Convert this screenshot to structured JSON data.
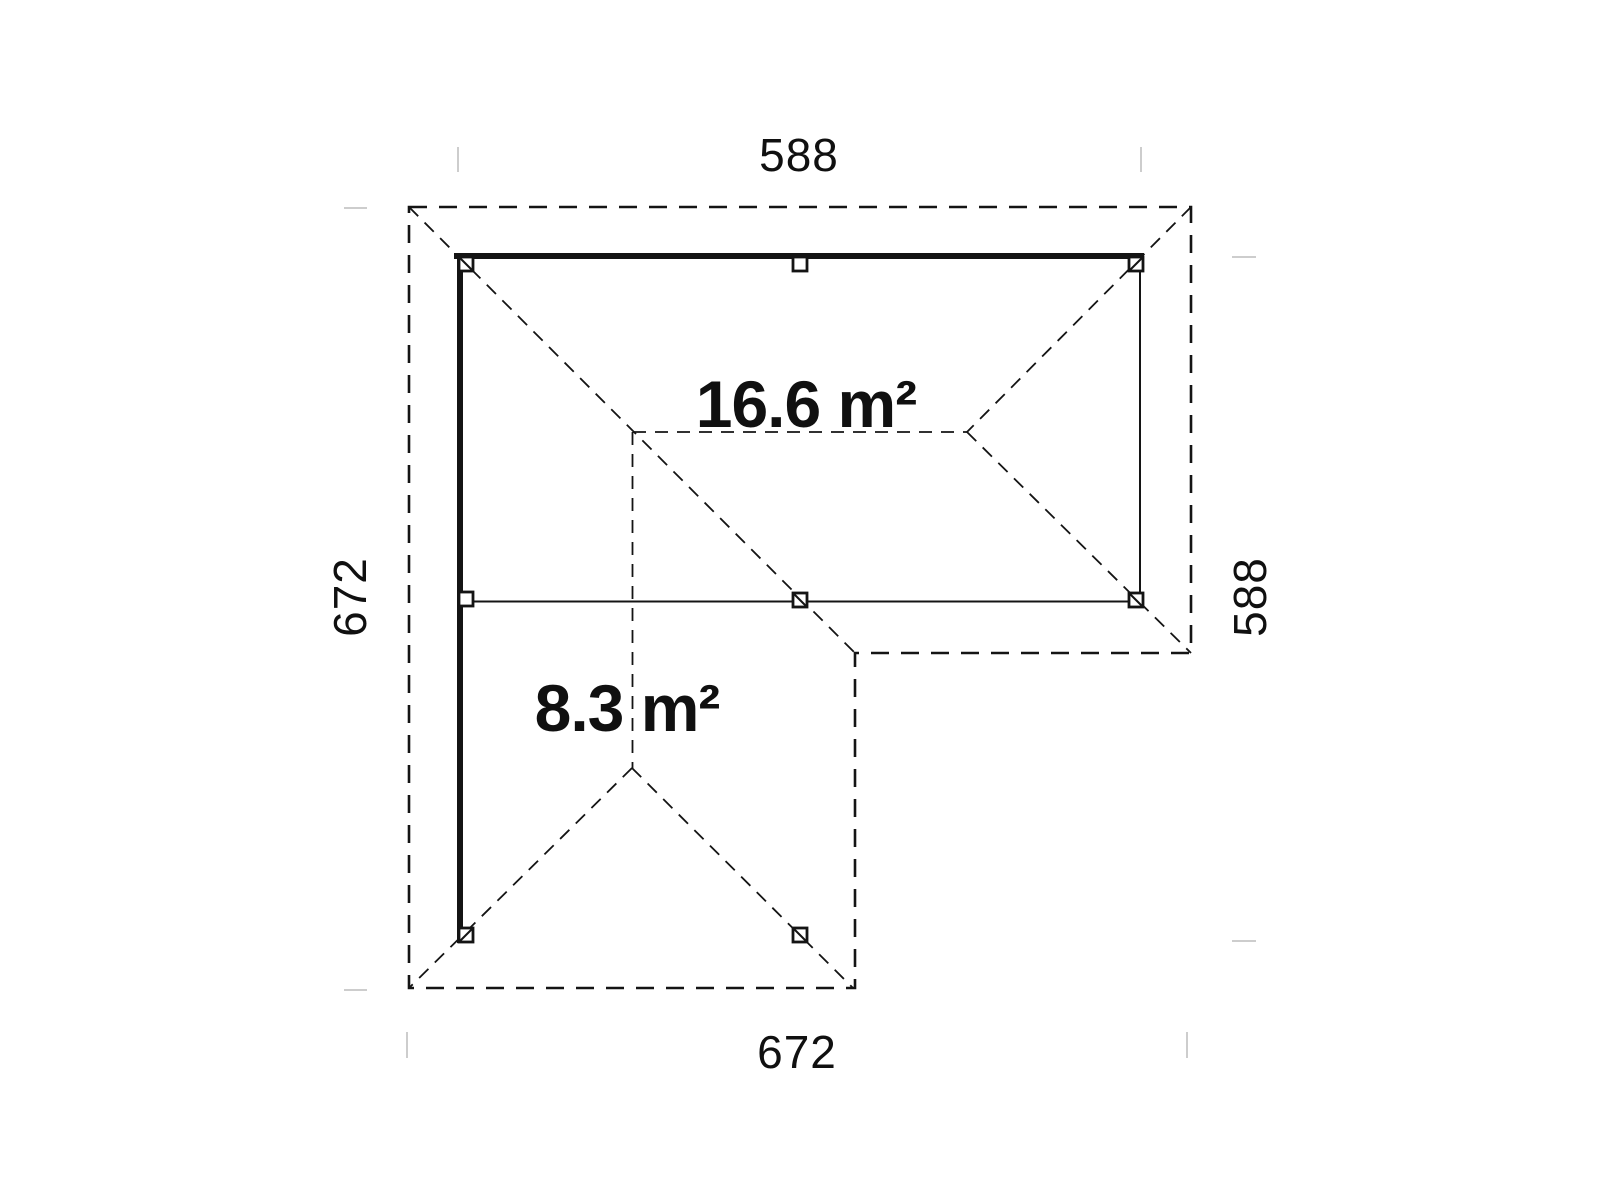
{
  "plan": {
    "areas": [
      {
        "id": "main-roof",
        "label": "16.6 m²"
      },
      {
        "id": "side-roof",
        "label": "8.3 m²"
      }
    ],
    "dimensions": {
      "top": "588",
      "right": "588",
      "left": "672",
      "bottom": "672"
    },
    "colors": {
      "line": "#141414",
      "background": "#ffffff",
      "witness_tick": "#cdcdcd"
    }
  }
}
